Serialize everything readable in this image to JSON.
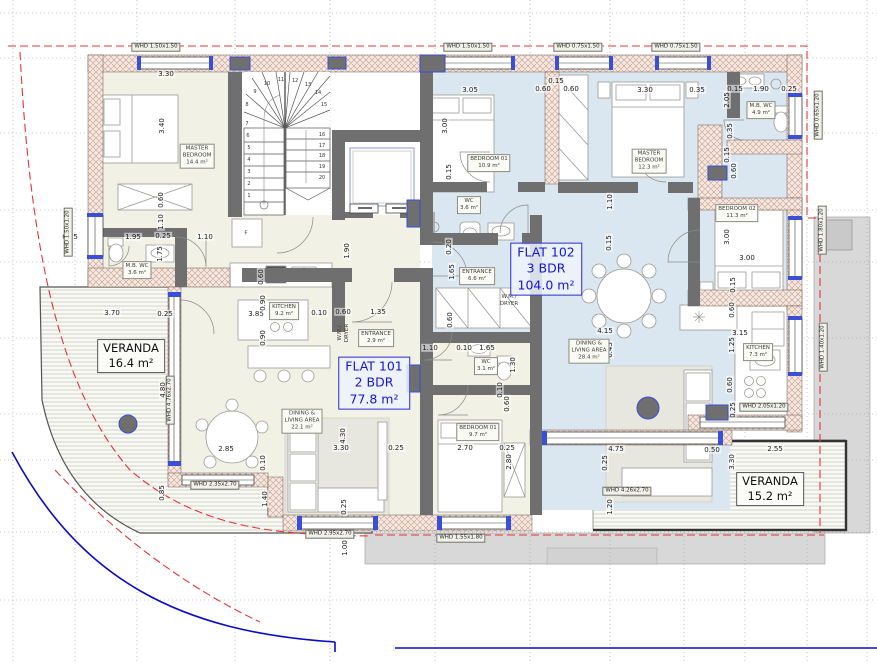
{
  "flats": [
    {
      "name": "FLAT 101",
      "type": "2 BDR",
      "area": "77.8 m²"
    },
    {
      "name": "FLAT 102",
      "type": "3 BDR",
      "area": "104.0 m²"
    }
  ],
  "verandas": [
    {
      "name": "VERANDA",
      "area": "16.4 m²"
    },
    {
      "name": "VERANDA",
      "area": "15.2 m²"
    }
  ],
  "rooms": [
    {
      "t": "MASTER\nBEDROOM\n14.4 m²",
      "x": 197,
      "y": 156
    },
    {
      "t": "M.B. WC\n3.6 m²",
      "x": 137,
      "y": 270
    },
    {
      "t": "KITCHEN\n9.2 m²",
      "x": 284,
      "y": 311
    },
    {
      "t": "ENTRANCE\n2.9 m²",
      "x": 376,
      "y": 338
    },
    {
      "t": "DINING &\nLIVING AREA\n22.1 m²",
      "x": 302,
      "y": 421
    },
    {
      "t": "BEDROOM 01\n9.7 m²",
      "x": 478,
      "y": 432
    },
    {
      "t": "WC\n3.1 m²",
      "x": 486,
      "y": 366
    },
    {
      "t": "W.M./\nDRYER",
      "x": 344,
      "y": 333,
      "v": 1,
      "plain": 1
    },
    {
      "t": "BEDROOM 01\n10.9 m²",
      "x": 489,
      "y": 163
    },
    {
      "t": "WC\n3.6 m²",
      "x": 469,
      "y": 205
    },
    {
      "t": "ENTRANCE\n6.6 m²",
      "x": 477,
      "y": 276
    },
    {
      "t": "W.M./\nDRYER",
      "x": 509,
      "y": 301,
      "plain": 1
    },
    {
      "t": "MASTER\nBEDROOM\n12.3 m²",
      "x": 649,
      "y": 161
    },
    {
      "t": "M.B. WC\n4.9 m²",
      "x": 761,
      "y": 110
    },
    {
      "t": "BEDROOM 02\n11.3 m²",
      "x": 737,
      "y": 213
    },
    {
      "t": "KITCHEN\n7.3 m²",
      "x": 758,
      "y": 352
    },
    {
      "t": "DINING &\nLIVING AREA\n28.4 m²",
      "x": 589,
      "y": 351
    },
    {
      "t": "F",
      "x": 246,
      "y": 234,
      "plain": 1
    }
  ],
  "window_labels": [
    {
      "t": "WHD 1.50x1.50",
      "x": 156,
      "y": 47
    },
    {
      "t": "WHD 1.50x1.50",
      "x": 468,
      "y": 47
    },
    {
      "t": "WHD 0.75x1.50",
      "x": 578,
      "y": 47
    },
    {
      "t": "WHD 0.75x1.50",
      "x": 676,
      "y": 47
    },
    {
      "t": "WHD 1.50x1.20",
      "x": 68,
      "y": 232,
      "v": 1
    },
    {
      "t": "WHD 0.65x1.20",
      "x": 818,
      "y": 115,
      "v": 1
    },
    {
      "t": "WHD 1.80x1.20",
      "x": 822,
      "y": 230,
      "v": 1
    },
    {
      "t": "WHD 1.40x1.20",
      "x": 823,
      "y": 347,
      "v": 1
    },
    {
      "t": "WHD 2.05x1.20",
      "x": 764,
      "y": 407
    },
    {
      "t": "WHD 4.76x2.70",
      "x": 170,
      "y": 400,
      "v": 1
    },
    {
      "t": "WHD 2.35x2.70",
      "x": 215,
      "y": 485
    },
    {
      "t": "WHD 2.95x2.70",
      "x": 330,
      "y": 534
    },
    {
      "t": "WHD 1.55x1.80",
      "x": 461,
      "y": 538
    },
    {
      "t": "WHD 4.26x2.70",
      "x": 627,
      "y": 491
    }
  ],
  "dimensions": [
    {
      "t": "3.30",
      "x": 166,
      "y": 74
    },
    {
      "t": "3.05",
      "x": 470,
      "y": 90
    },
    {
      "t": "0.60",
      "x": 543,
      "y": 89
    },
    {
      "t": "0.15",
      "x": 556,
      "y": 81
    },
    {
      "t": "0.60",
      "x": 571,
      "y": 89
    },
    {
      "t": "3.30",
      "x": 645,
      "y": 90
    },
    {
      "t": "0.35",
      "x": 697,
      "y": 90
    },
    {
      "t": "0.15",
      "x": 735,
      "y": 89
    },
    {
      "t": "1.90",
      "x": 761,
      "y": 89
    },
    {
      "t": "0.25",
      "x": 789,
      "y": 89
    },
    {
      "t": "0.25",
      "x": 70,
      "y": 237
    },
    {
      "t": "1.95",
      "x": 133,
      "y": 237
    },
    {
      "t": "0.25",
      "x": 163,
      "y": 236
    },
    {
      "t": "1.10",
      "x": 205,
      "y": 237
    },
    {
      "t": "3.70",
      "x": 112,
      "y": 313
    },
    {
      "t": "0.25",
      "x": 165,
      "y": 314
    },
    {
      "t": "3.85",
      "x": 256,
      "y": 314
    },
    {
      "t": "0.10",
      "x": 319,
      "y": 313
    },
    {
      "t": "0.60",
      "x": 343,
      "y": 312
    },
    {
      "t": "1.35",
      "x": 378,
      "y": 312
    },
    {
      "t": "1.10",
      "x": 430,
      "y": 348
    },
    {
      "t": "0.10",
      "x": 464,
      "y": 348
    },
    {
      "t": "1.65",
      "x": 487,
      "y": 348
    },
    {
      "t": "3.00",
      "x": 747,
      "y": 258
    },
    {
      "t": "3.15",
      "x": 740,
      "y": 333
    },
    {
      "t": "4.15",
      "x": 605,
      "y": 331
    },
    {
      "t": "2.85",
      "x": 226,
      "y": 449
    },
    {
      "t": "3.30",
      "x": 341,
      "y": 448
    },
    {
      "t": "0.25",
      "x": 396,
      "y": 448
    },
    {
      "t": "2.70",
      "x": 465,
      "y": 448
    },
    {
      "t": "0.25",
      "x": 507,
      "y": 448
    },
    {
      "t": "4.75",
      "x": 616,
      "y": 449
    },
    {
      "t": "0.50",
      "x": 712,
      "y": 450
    },
    {
      "t": "2.55",
      "x": 775,
      "y": 449
    },
    {
      "t": "3.40",
      "x": 162,
      "y": 126,
      "v": 1
    },
    {
      "t": "0.60",
      "x": 161,
      "y": 200,
      "v": 1
    },
    {
      "t": "1.10",
      "x": 161,
      "y": 222,
      "v": 1
    },
    {
      "t": "1.75",
      "x": 160,
      "y": 254,
      "v": 1
    },
    {
      "t": "3.00",
      "x": 445,
      "y": 126,
      "v": 1
    },
    {
      "t": "0.15",
      "x": 449,
      "y": 172,
      "v": 1
    },
    {
      "t": "2.05",
      "x": 727,
      "y": 100,
      "v": 1
    },
    {
      "t": "0.35",
      "x": 730,
      "y": 131,
      "v": 1
    },
    {
      "t": "0.15",
      "x": 727,
      "y": 155,
      "v": 1
    },
    {
      "t": "0.60",
      "x": 734,
      "y": 171,
      "v": 1
    },
    {
      "t": "1.10",
      "x": 610,
      "y": 202,
      "v": 1
    },
    {
      "t": "0.15",
      "x": 609,
      "y": 243,
      "v": 1
    },
    {
      "t": "0.20",
      "x": 449,
      "y": 247,
      "v": 1
    },
    {
      "t": "1.65",
      "x": 452,
      "y": 272,
      "v": 1
    },
    {
      "t": "0.60",
      "x": 450,
      "y": 320,
      "v": 1
    },
    {
      "t": "3.00",
      "x": 727,
      "y": 237,
      "v": 1
    },
    {
      "t": "0.15",
      "x": 733,
      "y": 285,
      "v": 1
    },
    {
      "t": "0.60",
      "x": 732,
      "y": 310,
      "v": 1
    },
    {
      "t": "1.25",
      "x": 732,
      "y": 345,
      "v": 1
    },
    {
      "t": "0.60",
      "x": 730,
      "y": 385,
      "v": 1
    },
    {
      "t": "0.25",
      "x": 733,
      "y": 410,
      "v": 1
    },
    {
      "t": "0.60",
      "x": 261,
      "y": 277,
      "v": 1
    },
    {
      "t": "0.90",
      "x": 263,
      "y": 303,
      "v": 1
    },
    {
      "t": "0.90",
      "x": 263,
      "y": 338,
      "v": 1
    },
    {
      "t": "1.90",
      "x": 347,
      "y": 251,
      "v": 1
    },
    {
      "t": "4.30",
      "x": 343,
      "y": 436,
      "v": 1
    },
    {
      "t": "0.25",
      "x": 344,
      "y": 507,
      "v": 1
    },
    {
      "t": "0.10",
      "x": 263,
      "y": 463,
      "v": 1
    },
    {
      "t": "1.40",
      "x": 265,
      "y": 499,
      "v": 1
    },
    {
      "t": "0.85",
      "x": 162,
      "y": 493,
      "v": 1
    },
    {
      "t": "4.80",
      "x": 163,
      "y": 390,
      "v": 1
    },
    {
      "t": "1.30",
      "x": 513,
      "y": 365,
      "v": 1
    },
    {
      "t": "0.10",
      "x": 500,
      "y": 390,
      "v": 1
    },
    {
      "t": "0.60",
      "x": 507,
      "y": 404,
      "v": 1
    },
    {
      "t": "2.80",
      "x": 509,
      "y": 462,
      "v": 1
    },
    {
      "t": "0.25",
      "x": 605,
      "y": 463,
      "v": 1
    },
    {
      "t": "3.30",
      "x": 732,
      "y": 462,
      "v": 1
    },
    {
      "t": "1.20",
      "x": 610,
      "y": 507,
      "v": 1
    },
    {
      "t": "6.45",
      "x": 610,
      "y": 350,
      "v": 1
    },
    {
      "t": "1.00",
      "x": 345,
      "y": 548,
      "v": 1
    }
  ],
  "stair_steps": [
    {
      "t": "1",
      "x": 249,
      "y": 196
    },
    {
      "t": "2",
      "x": 249,
      "y": 184
    },
    {
      "t": "3",
      "x": 249,
      "y": 172
    },
    {
      "t": "4",
      "x": 249,
      "y": 160
    },
    {
      "t": "5",
      "x": 249,
      "y": 148
    },
    {
      "t": "6",
      "x": 248,
      "y": 136
    },
    {
      "t": "7",
      "x": 247,
      "y": 124
    },
    {
      "t": "8",
      "x": 247,
      "y": 105
    },
    {
      "t": "9",
      "x": 255,
      "y": 92
    },
    {
      "t": "10",
      "x": 267,
      "y": 84
    },
    {
      "t": "11",
      "x": 281,
      "y": 80
    },
    {
      "t": "12",
      "x": 295,
      "y": 81
    },
    {
      "t": "13",
      "x": 308,
      "y": 85
    },
    {
      "t": "14",
      "x": 318,
      "y": 93
    },
    {
      "t": "15",
      "x": 324,
      "y": 105
    },
    {
      "t": "16",
      "x": 322,
      "y": 135
    },
    {
      "t": "17",
      "x": 322,
      "y": 146
    },
    {
      "t": "18",
      "x": 322,
      "y": 156
    },
    {
      "t": "19",
      "x": 322,
      "y": 167
    },
    {
      "t": "20",
      "x": 322,
      "y": 178
    }
  ],
  "colors": {
    "flat101-fill": "#f2f1e6",
    "flat102-fill": "#dbe7f0",
    "wall-gray": "#6f6f6f",
    "hatch-brown": "#c79a84",
    "accent-blue": "#3a4fd7",
    "label-blue": "#1515dd",
    "red-dash": "#e43535",
    "site-blue": "#0a0acc",
    "surround-gray": "#d8d8d8"
  }
}
